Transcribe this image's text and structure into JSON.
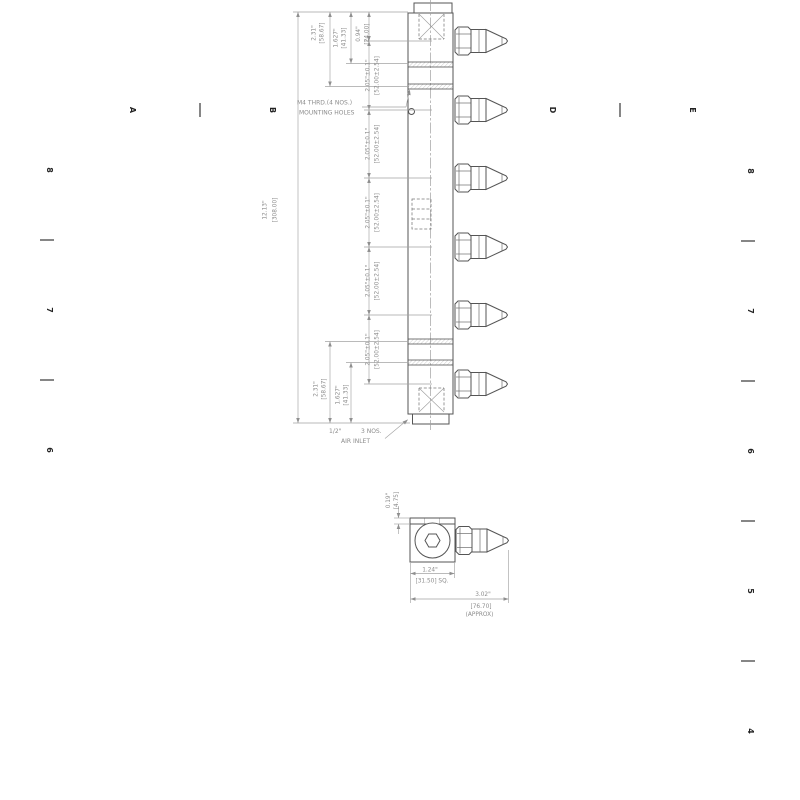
{
  "sheet": {
    "background": "#ffffff",
    "line_color": "#555555",
    "dim_color": "#8c8c8c",
    "zones": {
      "top": [
        {
          "text": "A",
          "x": 130
        },
        {
          "text": "B",
          "x": 270
        },
        {
          "text": "D",
          "x": 550
        },
        {
          "text": "E",
          "x": 690
        }
      ],
      "top_seps": [
        200,
        620
      ],
      "left": [
        {
          "text": "8",
          "y": 170
        },
        {
          "text": "7",
          "y": 310
        },
        {
          "text": "6",
          "y": 450
        }
      ],
      "left_seps": [
        240,
        380
      ],
      "right": [
        {
          "text": "8",
          "y": 171
        },
        {
          "text": "7",
          "y": 311
        },
        {
          "text": "6",
          "y": 451
        },
        {
          "text": "5",
          "y": 591
        },
        {
          "text": "4",
          "y": 731
        }
      ],
      "right_seps": [
        241,
        381,
        521,
        661
      ]
    }
  },
  "main_view": {
    "nozzle_count": 6,
    "overall": {
      "in": "12.13\"",
      "mm": "[308.00]"
    },
    "offsets_top": [
      {
        "in": "2.31\"",
        "mm": "[58.67]"
      },
      {
        "in": "1.627\"",
        "mm": "[41.33]"
      },
      {
        "in": "0.94\"",
        "mm": "[24.00]"
      }
    ],
    "offsets_bottom": [
      {
        "in": "2.31\"",
        "mm": "[58.67]"
      },
      {
        "in": "1.627\"",
        "mm": "[41.33]"
      }
    ],
    "pitch": {
      "in": "2.05\"±0.1\"",
      "mm": "[52.00±2.54]"
    },
    "notes": {
      "mounting_line1": "M4 THRD.(4 NOS.)",
      "mounting_line2": "MOUNTING HOLES",
      "inlet_size": "1/2\"",
      "inlet_qty": "3 NOS.",
      "inlet_name": "AIR INLET"
    }
  },
  "detail_view": {
    "offset": {
      "in": "0.19\"",
      "mm": "[4.75]"
    },
    "square": {
      "in": "1.24\"",
      "mm": "[31.50] SQ."
    },
    "overall": {
      "in": "3.02\"",
      "mm": "[76.70]",
      "approx": "(APPROX)"
    }
  }
}
